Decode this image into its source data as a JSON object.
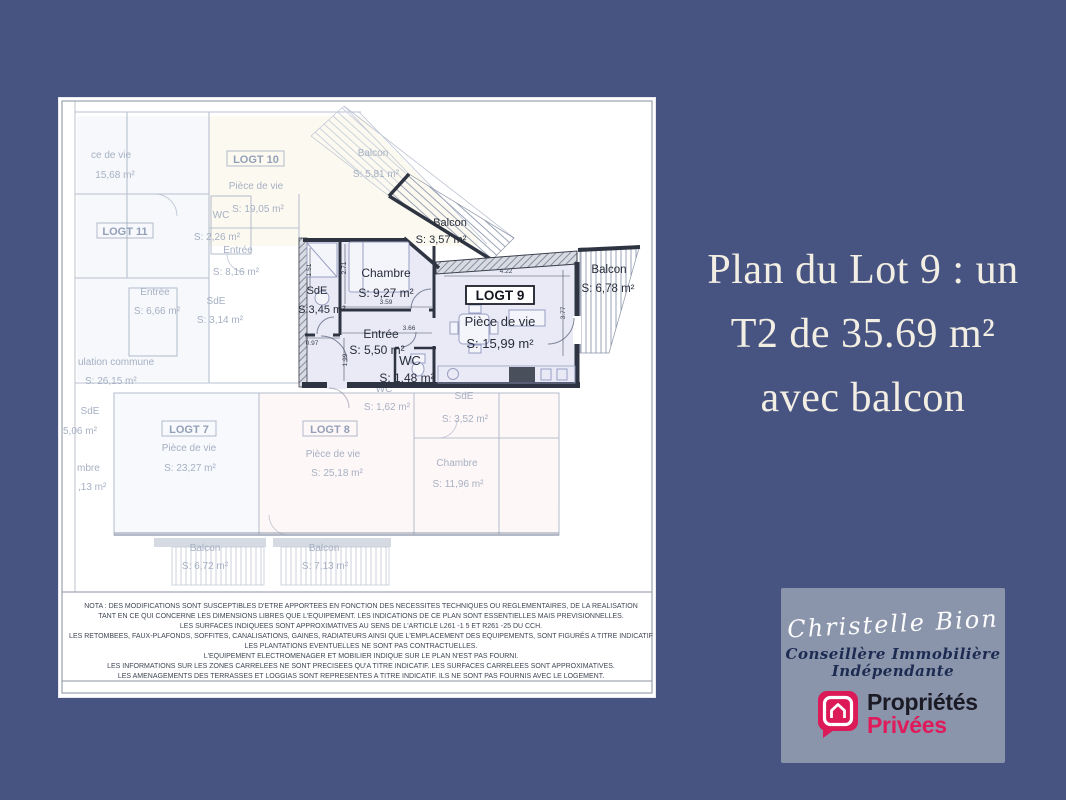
{
  "colors": {
    "background": "#475481",
    "headline_text": "#f2eee3",
    "card_bg": "#8a94ab",
    "brand_pink": "#E01A5B",
    "plan_highlight_fill": "#e9eaf6",
    "plan_wall_dark": "#2f3442"
  },
  "headline": {
    "line1": "Plan du Lot 9 : un",
    "line2": "T2 de 35.69 m²",
    "line3": "avec balcon"
  },
  "plan": {
    "logt9": {
      "label": "LOGT 9",
      "piece_name": "Pièce de vie",
      "piece_area": "S: 15,99 m²",
      "chambre_name": "Chambre",
      "chambre_area": "S: 9,27 m²",
      "sde_name": "SdE",
      "sde_area": "S:3,45 m²",
      "entree_name": "Entrée",
      "entree_area": "S: 5,50 m²",
      "wc_name": "WC",
      "wc_area": "S: 1,48 m²",
      "balcon_top_name": "Balcon",
      "balcon_top_area": "S: 3,57 m²",
      "balcon_right_name": "Balcon",
      "balcon_right_area": "S: 6,78 m²",
      "dims": {
        "piece_w": "4.22",
        "piece_h": "3.77",
        "chambre_w": "3.59",
        "chambre_h": "2.71",
        "entree_w": "3.66",
        "sde_w": "0.97",
        "sde_h": "1.51",
        "entree_h": "1.99"
      }
    },
    "faded": {
      "logt10_label": "LOGT 10",
      "logt10_room": "Pièce de vie",
      "logt10_area": "S: 19,05 m²",
      "logt11_label": "LOGT 11",
      "piece_cut_name": "ce de vie",
      "piece_cut_area": "15,68 m²",
      "wc10_name": "WC",
      "wc10_area": "S: 2,26 m²",
      "entree10_name": "Entrée",
      "entree10_area": "S: 8,16 m²",
      "entree11_name": "Entrée",
      "entree11_area": "S: 6,66 m²",
      "sde11_name": "SdE",
      "sde11_area": "S: 3,14 m²",
      "circulation_name": "ulation commune",
      "circulation_area": "S: 26,15 m²",
      "balcon10_name": "Balcon",
      "balcon10_area": "S: 5,81 m²",
      "sde_left_name": "SdE",
      "sde_left_area": "5,06 m²",
      "chambre_cut_name": "mbre",
      "chambre_cut_area": ",13 m²",
      "logt7_label": "LOGT 7",
      "logt7_room": "Pièce de vie",
      "logt7_area": "S: 23,27 m²",
      "logt8_label": "LOGT 8",
      "logt8_room": "Pièce de vie",
      "logt8_area": "S: 25,18 m²",
      "wc8_name": "WC",
      "wc8_area": "S: 1,62 m²",
      "sde8_name": "SdE",
      "sde8_area": "S: 3,52 m²",
      "chambre8_name": "Chambre",
      "chambre8_area": "S: 11,96 m²",
      "balcon7_name": "Balcon",
      "balcon7_area": "S: 6,72 m²",
      "balcon8_name": "Balcon",
      "balcon8_area": "S: 7,13 m²"
    },
    "nota_lines": [
      "NOTA : DES MODIFICATIONS SONT SUSCEPTIBLES D'ETRE APPORTEES EN FONCTION DES NECESSITES TECHNIQUES OU REGLEMENTAIRES, DE LA REALISATION",
      "TANT EN CE QUI CONCERNE LES DIMENSIONS LIBRES QUE L'EQUIPEMENT. LES INDICATIONS DE CE PLAN SONT ESSENTIELLES MAIS PREVISIONNELLES.",
      "LES SURFACES INDIQUEES SONT APPROXIMATIVES AU SENS DE L'ARTICLE L261 -1 5 ET R261 -25 DU CCH.",
      "LES RETOMBEES, FAUX-PLAFONDS, SOFFITES, CANALISATIONS, GAINES, RADIATEURS AINSI QUE L'EMPLACEMENT DES EQUIPEMENTS, SONT FIGURÉS A TITRE INDICATIF",
      "LES PLANTATIONS EVENTUELLES NE SONT PAS CONTRACTUELLES.",
      "L'EQUIPEMENT ELECTROMENAGER ET MOBILIER INDIQUE SUR LE PLAN N'EST PAS FOURNI.",
      "LES INFORMATIONS SUR LES ZONES CARRELEES NE SONT PRECISEES QU'A TITRE INDICATIF. LES SURFACES CARRELEES SONT APPROXIMATIVES.",
      "LES AMENAGEMENTS DES TERRASSES ET LOGGIAS SONT REPRESENTES A TITRE INDICATIF. ILS NE SONT PAS FOURNIS AVEC LE LOGEMENT."
    ]
  },
  "agent_card": {
    "signature": "Christelle Bion",
    "role_line1": "Conseillère Immobilière",
    "role_line2": "Indépendante",
    "brand_top": "Propriétés",
    "brand_bottom": "Privées"
  }
}
